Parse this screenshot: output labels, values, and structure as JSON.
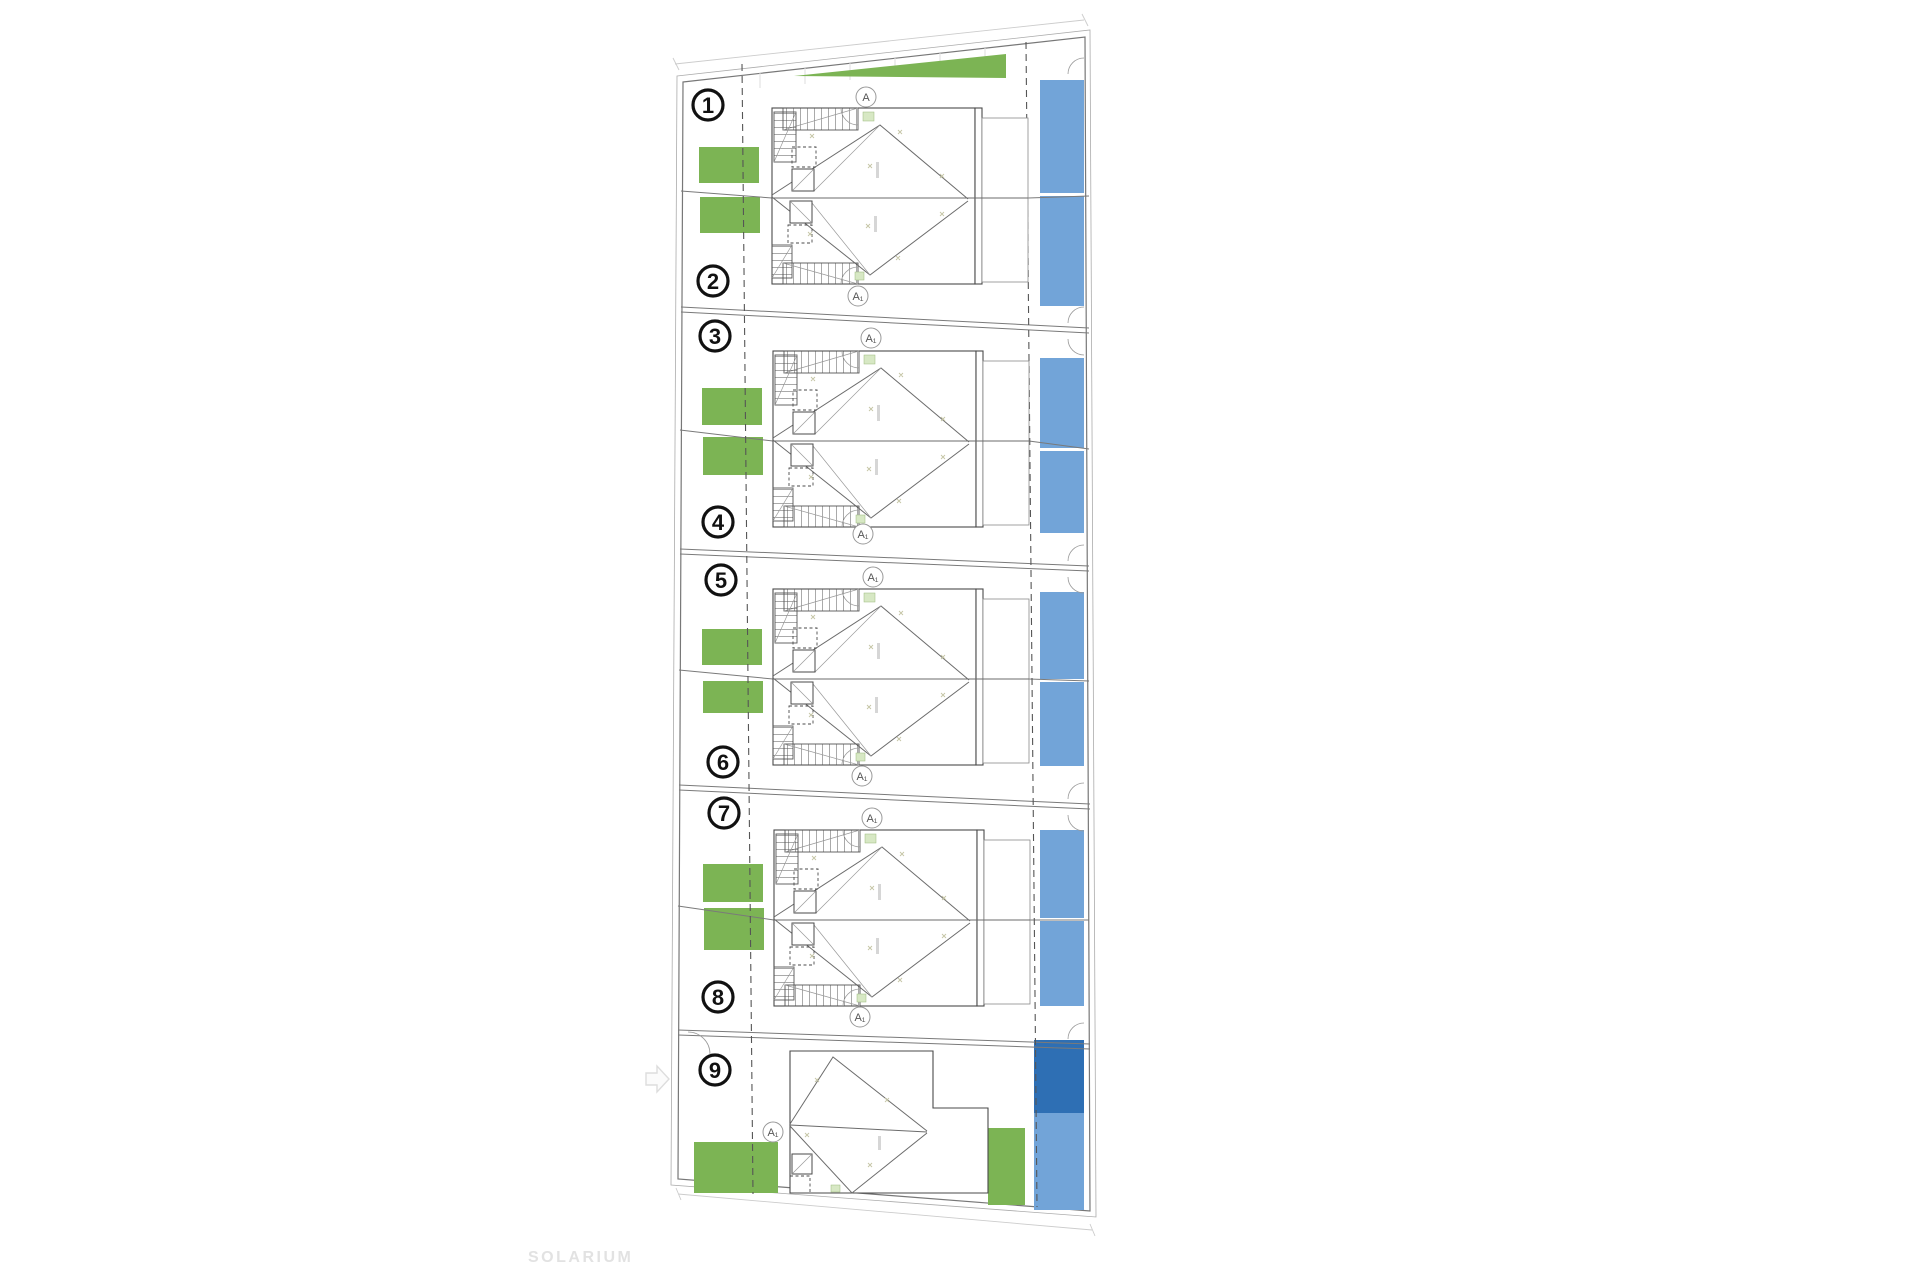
{
  "plan": {
    "solarium_label": "SOLARIUM",
    "units": [
      "1",
      "2",
      "3",
      "4",
      "5",
      "6",
      "7",
      "8",
      "9"
    ],
    "section_markers": [
      {
        "label": "A"
      },
      {
        "label": "A₁"
      },
      {
        "label": "A₁"
      },
      {
        "label": "A₁"
      },
      {
        "label": "A₁"
      },
      {
        "label": "A₁"
      },
      {
        "label": "A₁"
      },
      {
        "label": "A₁"
      },
      {
        "label": "A₁"
      }
    ],
    "icons": {
      "north_arrow": "right-arrow-outline"
    },
    "colors": {
      "garden_green": "#7CB454",
      "pool_blue": "#72A4D8",
      "pool_blue_dark": "#2E6FB4",
      "accent_mini_green": "#D7E8C4",
      "plan_line": "#4a4a4a",
      "border_line": "#777777",
      "divider_line": "#7a7a7a",
      "dashed_line": "#555555",
      "marker_line": "#999999",
      "number_black": "#111111",
      "label_gray": "#e2e2e2"
    }
  }
}
